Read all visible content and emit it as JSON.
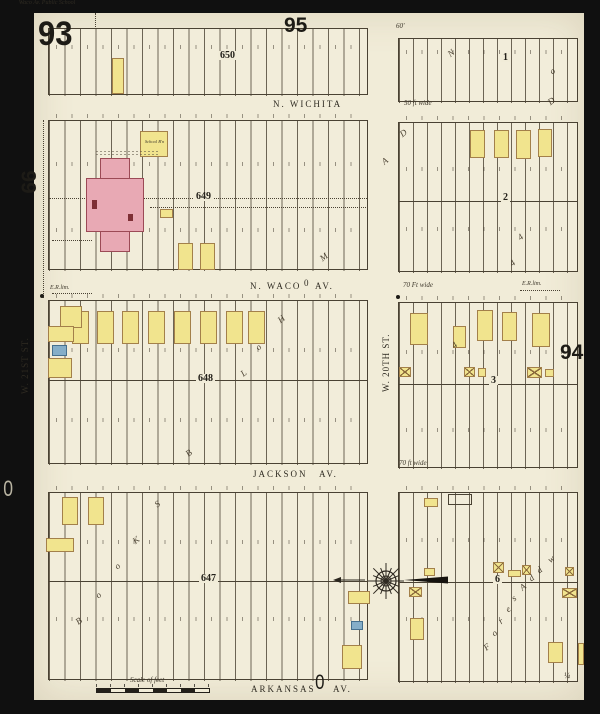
{
  "sheet": {
    "number": "93",
    "adjacent_top": "95",
    "adjacent_left": "99",
    "adjacent_right": "94",
    "edge_letter_left": "0",
    "edge_letter_bottom": "0",
    "corner_note": "¼"
  },
  "streets": {
    "n_wichita": "N. WICHITA",
    "n_waco": "N. WACO",
    "n_waco_av": "AV.",
    "waco_symbol": "0",
    "jackson": "JACKSON",
    "jackson_av": "AV.",
    "arkansas": "ARKANSAS",
    "arkansas_av": "AV.",
    "w_21st": "W. 21ST ST.",
    "w_20th": "W. 20TH ST.",
    "note_50": "50 ft wide",
    "note_70_waco": "70 Ft wide",
    "note_70_jackson": "70 ft wide",
    "note_60": "60'",
    "er_lim_left": "E.R.lim.",
    "er_lim_right": "E.R.lim.",
    "scale_label": "Scale of feet"
  },
  "labels": {
    "school": "Waco Av. Public School",
    "school_annex": "School B'n"
  },
  "palette": {
    "paper": "#f1ecd8",
    "ink": "#4a4233",
    "frame_yellow": "#f1e48e",
    "brick_pink": "#e8a9b4",
    "special_blue": "#85aec8",
    "detail_red": "#7e2f35",
    "surround_black": "#101010"
  },
  "geometry": {
    "blocks": [
      {
        "label": "650",
        "x": 48,
        "y": 28,
        "w": 320,
        "h": 67,
        "alley": null,
        "sp": 15.5,
        "lx": 218,
        "ly": 51,
        "nums": [
          45
        ]
      },
      {
        "label": "649",
        "x": 48,
        "y": 120,
        "w": 320,
        "h": 150,
        "alley": 197,
        "dot": true,
        "sp": 15.5,
        "lx": 194,
        "ly": 192,
        "nums": [
          162,
          228,
          114
        ]
      },
      {
        "label": "648",
        "x": 48,
        "y": 300,
        "w": 320,
        "h": 164,
        "alley": 379,
        "sp": 15.5,
        "lx": 196,
        "ly": 374,
        "nums": [
          348,
          418,
          294
        ]
      },
      {
        "label": "647",
        "x": 48,
        "y": 492,
        "w": 320,
        "h": 188,
        "alley": 580,
        "sp": 15.5,
        "lx": 199,
        "ly": 574,
        "nums": [
          540,
          617,
          486
        ]
      },
      {
        "label": "1",
        "x": 398,
        "y": 38,
        "w": 180,
        "h": 64,
        "alley": null,
        "sp": 14,
        "lx": 501,
        "ly": 53,
        "nums": [
          50
        ]
      },
      {
        "label": "2",
        "x": 398,
        "y": 122,
        "w": 180,
        "h": 150,
        "alley": 200,
        "sp": 14,
        "lx": 501,
        "ly": 193,
        "nums": [
          167,
          227,
          116
        ]
      },
      {
        "label": "3",
        "x": 398,
        "y": 302,
        "w": 180,
        "h": 166,
        "alley": 383,
        "sp": 14,
        "lx": 489,
        "ly": 376,
        "nums": [
          350,
          428,
          296
        ]
      },
      {
        "label": "6",
        "x": 398,
        "y": 492,
        "w": 180,
        "h": 190,
        "alley": 581,
        "sp": 14,
        "lx": 493,
        "ly": 575,
        "nums": [
          538,
          617,
          486
        ]
      }
    ],
    "buildings": [
      {
        "x": 112,
        "y": 58,
        "w": 12,
        "h": 36,
        "f": "y"
      },
      {
        "x": 140,
        "y": 131,
        "w": 28,
        "h": 26,
        "f": "y"
      },
      {
        "x": 100,
        "y": 158,
        "w": 30,
        "h": 94,
        "f": "p"
      },
      {
        "x": 86,
        "y": 178,
        "w": 58,
        "h": 54,
        "f": "p"
      },
      {
        "x": 92,
        "y": 200,
        "w": 5,
        "h": 9,
        "f": "r"
      },
      {
        "x": 128,
        "y": 214,
        "w": 5,
        "h": 7,
        "f": "r"
      },
      {
        "x": 160,
        "y": 209,
        "w": 13,
        "h": 9,
        "f": "y"
      },
      {
        "x": 178,
        "y": 243,
        "w": 15,
        "h": 27,
        "f": "y"
      },
      {
        "x": 200,
        "y": 243,
        "w": 15,
        "h": 27,
        "f": "y"
      },
      {
        "x": 72,
        "y": 311,
        "w": 17,
        "h": 33,
        "f": "y"
      },
      {
        "x": 97,
        "y": 311,
        "w": 17,
        "h": 33,
        "f": "y"
      },
      {
        "x": 122,
        "y": 311,
        "w": 17,
        "h": 33,
        "f": "y"
      },
      {
        "x": 148,
        "y": 311,
        "w": 17,
        "h": 33,
        "f": "y"
      },
      {
        "x": 174,
        "y": 311,
        "w": 17,
        "h": 33,
        "f": "y"
      },
      {
        "x": 200,
        "y": 311,
        "w": 17,
        "h": 33,
        "f": "y"
      },
      {
        "x": 226,
        "y": 311,
        "w": 17,
        "h": 33,
        "f": "y"
      },
      {
        "x": 248,
        "y": 311,
        "w": 17,
        "h": 33,
        "f": "y"
      },
      {
        "x": 60,
        "y": 306,
        "w": 22,
        "h": 22,
        "f": "y"
      },
      {
        "x": 48,
        "y": 326,
        "w": 26,
        "h": 16,
        "f": "y"
      },
      {
        "x": 52,
        "y": 345,
        "w": 15,
        "h": 11,
        "f": "b"
      },
      {
        "x": 48,
        "y": 358,
        "w": 24,
        "h": 20,
        "f": "y"
      },
      {
        "x": 62,
        "y": 497,
        "w": 16,
        "h": 28,
        "f": "y"
      },
      {
        "x": 88,
        "y": 497,
        "w": 16,
        "h": 28,
        "f": "y"
      },
      {
        "x": 46,
        "y": 538,
        "w": 28,
        "h": 14,
        "f": "y"
      },
      {
        "x": 348,
        "y": 591,
        "w": 22,
        "h": 13,
        "f": "y"
      },
      {
        "x": 351,
        "y": 621,
        "w": 12,
        "h": 9,
        "f": "b"
      },
      {
        "x": 342,
        "y": 645,
        "w": 20,
        "h": 24,
        "f": "y"
      },
      {
        "x": 470,
        "y": 130,
        "w": 15,
        "h": 28,
        "f": "y"
      },
      {
        "x": 494,
        "y": 130,
        "w": 15,
        "h": 28,
        "f": "y"
      },
      {
        "x": 516,
        "y": 130,
        "w": 15,
        "h": 29,
        "f": "y"
      },
      {
        "x": 538,
        "y": 129,
        "w": 14,
        "h": 28,
        "f": "y"
      },
      {
        "x": 410,
        "y": 313,
        "w": 18,
        "h": 32,
        "f": "y"
      },
      {
        "x": 453,
        "y": 326,
        "w": 13,
        "h": 22,
        "f": "y"
      },
      {
        "x": 477,
        "y": 310,
        "w": 16,
        "h": 31,
        "f": "y"
      },
      {
        "x": 502,
        "y": 312,
        "w": 15,
        "h": 29,
        "f": "y"
      },
      {
        "x": 532,
        "y": 313,
        "w": 18,
        "h": 34,
        "f": "y"
      },
      {
        "x": 399,
        "y": 367,
        "w": 12,
        "h": 10,
        "f": "y",
        "xm": true
      },
      {
        "x": 464,
        "y": 367,
        "w": 11,
        "h": 10,
        "f": "y",
        "xm": true
      },
      {
        "x": 478,
        "y": 368,
        "w": 8,
        "h": 9,
        "f": "y"
      },
      {
        "x": 527,
        "y": 367,
        "w": 15,
        "h": 11,
        "f": "y",
        "xm": true
      },
      {
        "x": 545,
        "y": 369,
        "w": 9,
        "h": 8,
        "f": "y"
      },
      {
        "x": 424,
        "y": 568,
        "w": 11,
        "h": 8,
        "f": "y"
      },
      {
        "x": 448,
        "y": 494,
        "w": 24,
        "h": 11,
        "f": "o"
      },
      {
        "x": 424,
        "y": 498,
        "w": 14,
        "h": 9,
        "f": "y"
      },
      {
        "x": 493,
        "y": 562,
        "w": 11,
        "h": 11,
        "f": "y",
        "xm": true
      },
      {
        "x": 508,
        "y": 570,
        "w": 13,
        "h": 7,
        "f": "y"
      },
      {
        "x": 522,
        "y": 565,
        "w": 9,
        "h": 10,
        "f": "y",
        "xm": true
      },
      {
        "x": 565,
        "y": 567,
        "w": 9,
        "h": 9,
        "f": "y",
        "xm": true
      },
      {
        "x": 409,
        "y": 587,
        "w": 13,
        "h": 10,
        "f": "y",
        "xm": true
      },
      {
        "x": 562,
        "y": 588,
        "w": 15,
        "h": 10,
        "f": "y",
        "xm": true
      },
      {
        "x": 410,
        "y": 618,
        "w": 14,
        "h": 22,
        "f": "y"
      },
      {
        "x": 548,
        "y": 642,
        "w": 15,
        "h": 21,
        "f": "y"
      },
      {
        "x": 578,
        "y": 643,
        "w": 6,
        "h": 22,
        "f": "y"
      }
    ],
    "script_letters": [
      {
        "ch": "N",
        "x": 448,
        "y": 48
      },
      {
        "ch": "o",
        "x": 550,
        "y": 66
      },
      {
        "ch": "D",
        "x": 548,
        "y": 96
      },
      {
        "ch": "A",
        "x": 382,
        "y": 156
      },
      {
        "ch": "D",
        "x": 400,
        "y": 128
      },
      {
        "ch": "M",
        "x": 320,
        "y": 252
      },
      {
        "ch": "H",
        "x": 278,
        "y": 314
      },
      {
        "ch": "o",
        "x": 256,
        "y": 342
      },
      {
        "ch": "L",
        "x": 241,
        "y": 368
      },
      {
        "ch": "B",
        "x": 186,
        "y": 448
      },
      {
        "ch": "S",
        "x": 155,
        "y": 499
      },
      {
        "ch": "K",
        "x": 133,
        "y": 535
      },
      {
        "ch": "o",
        "x": 115,
        "y": 561
      },
      {
        "ch": "o",
        "x": 96,
        "y": 590
      },
      {
        "ch": "B",
        "x": 76,
        "y": 616
      },
      {
        "ch": "4",
        "x": 518,
        "y": 232
      },
      {
        "ch": "4",
        "x": 510,
        "y": 258
      },
      {
        "ch": "4",
        "x": 452,
        "y": 340
      },
      {
        "ch": "F",
        "x": 484,
        "y": 642
      },
      {
        "ch": "o",
        "x": 492,
        "y": 628
      },
      {
        "ch": "r",
        "x": 499,
        "y": 616
      },
      {
        "ch": "e",
        "x": 506,
        "y": 604
      },
      {
        "ch": "s",
        "x": 512,
        "y": 593
      },
      {
        "ch": "A",
        "x": 520,
        "y": 582
      },
      {
        "ch": "d",
        "x": 529,
        "y": 573
      },
      {
        "ch": "d",
        "x": 537,
        "y": 565
      },
      {
        "ch": "w",
        "x": 548,
        "y": 554
      }
    ],
    "dotlines": [
      {
        "x": 43,
        "y": 120,
        "len": 178,
        "dir": "v"
      },
      {
        "x": 95,
        "y": 13,
        "len": 16,
        "dir": "v"
      },
      {
        "x": 52,
        "y": 293,
        "len": 40,
        "dir": "h"
      },
      {
        "x": 150,
        "y": 207,
        "len": 218,
        "dir": "h"
      },
      {
        "x": 520,
        "y": 290,
        "len": 40,
        "dir": "h"
      },
      {
        "x": 52,
        "y": 240,
        "len": 40,
        "dir": "h"
      }
    ],
    "dots": [
      {
        "x": 40,
        "y": 294
      },
      {
        "x": 396,
        "y": 295
      }
    ],
    "compass": {
      "cx": 386,
      "cy": 581,
      "r": 13
    },
    "arrow_left": {
      "x1": 338,
      "x2": 365,
      "y": 580
    },
    "dart": {
      "tipx": 404,
      "tailx": 448,
      "y": 580,
      "halfw": 3.5
    }
  }
}
